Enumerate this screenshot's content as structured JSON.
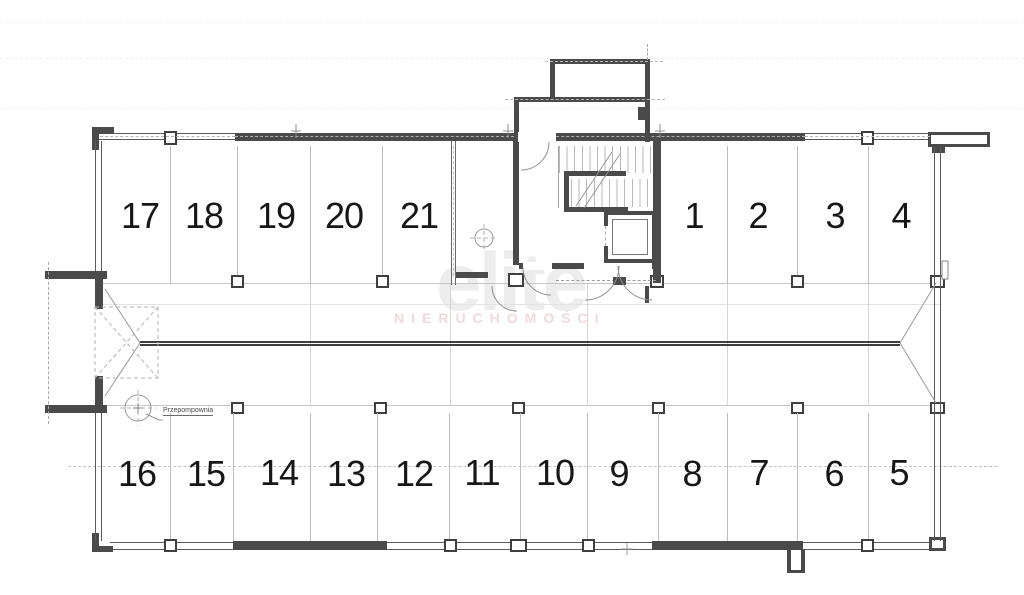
{
  "document": {
    "type": "garage-floor-plan"
  },
  "spaces": {
    "n1": {
      "label": "1"
    },
    "n2": {
      "label": "2"
    },
    "n3": {
      "label": "3"
    },
    "n4": {
      "label": "4"
    },
    "n5": {
      "label": "5"
    },
    "n6": {
      "label": "6"
    },
    "n7": {
      "label": "7"
    },
    "n8": {
      "label": "8"
    },
    "n9": {
      "label": "9"
    },
    "n10": {
      "label": "10"
    },
    "n11": {
      "label": "11"
    },
    "n12": {
      "label": "12"
    },
    "n13": {
      "label": "13"
    },
    "n14": {
      "label": "14"
    },
    "n15": {
      "label": "15"
    },
    "n16": {
      "label": "16"
    },
    "n17": {
      "label": "17"
    },
    "n18": {
      "label": "18"
    },
    "n19": {
      "label": "19"
    },
    "n20": {
      "label": "20"
    },
    "n21": {
      "label": "21"
    }
  },
  "labels": {
    "pump": "Przepompownia"
  },
  "watermark": {
    "logo": "elite",
    "subtitle": "NIERUCHOMOŚCI"
  },
  "colors": {
    "wall": "#4a4a4a",
    "partition": "#b9b9b9",
    "watermark_logo": "#ededed",
    "watermark_subtitle": "#f1d9d9",
    "background": "#ffffff"
  }
}
